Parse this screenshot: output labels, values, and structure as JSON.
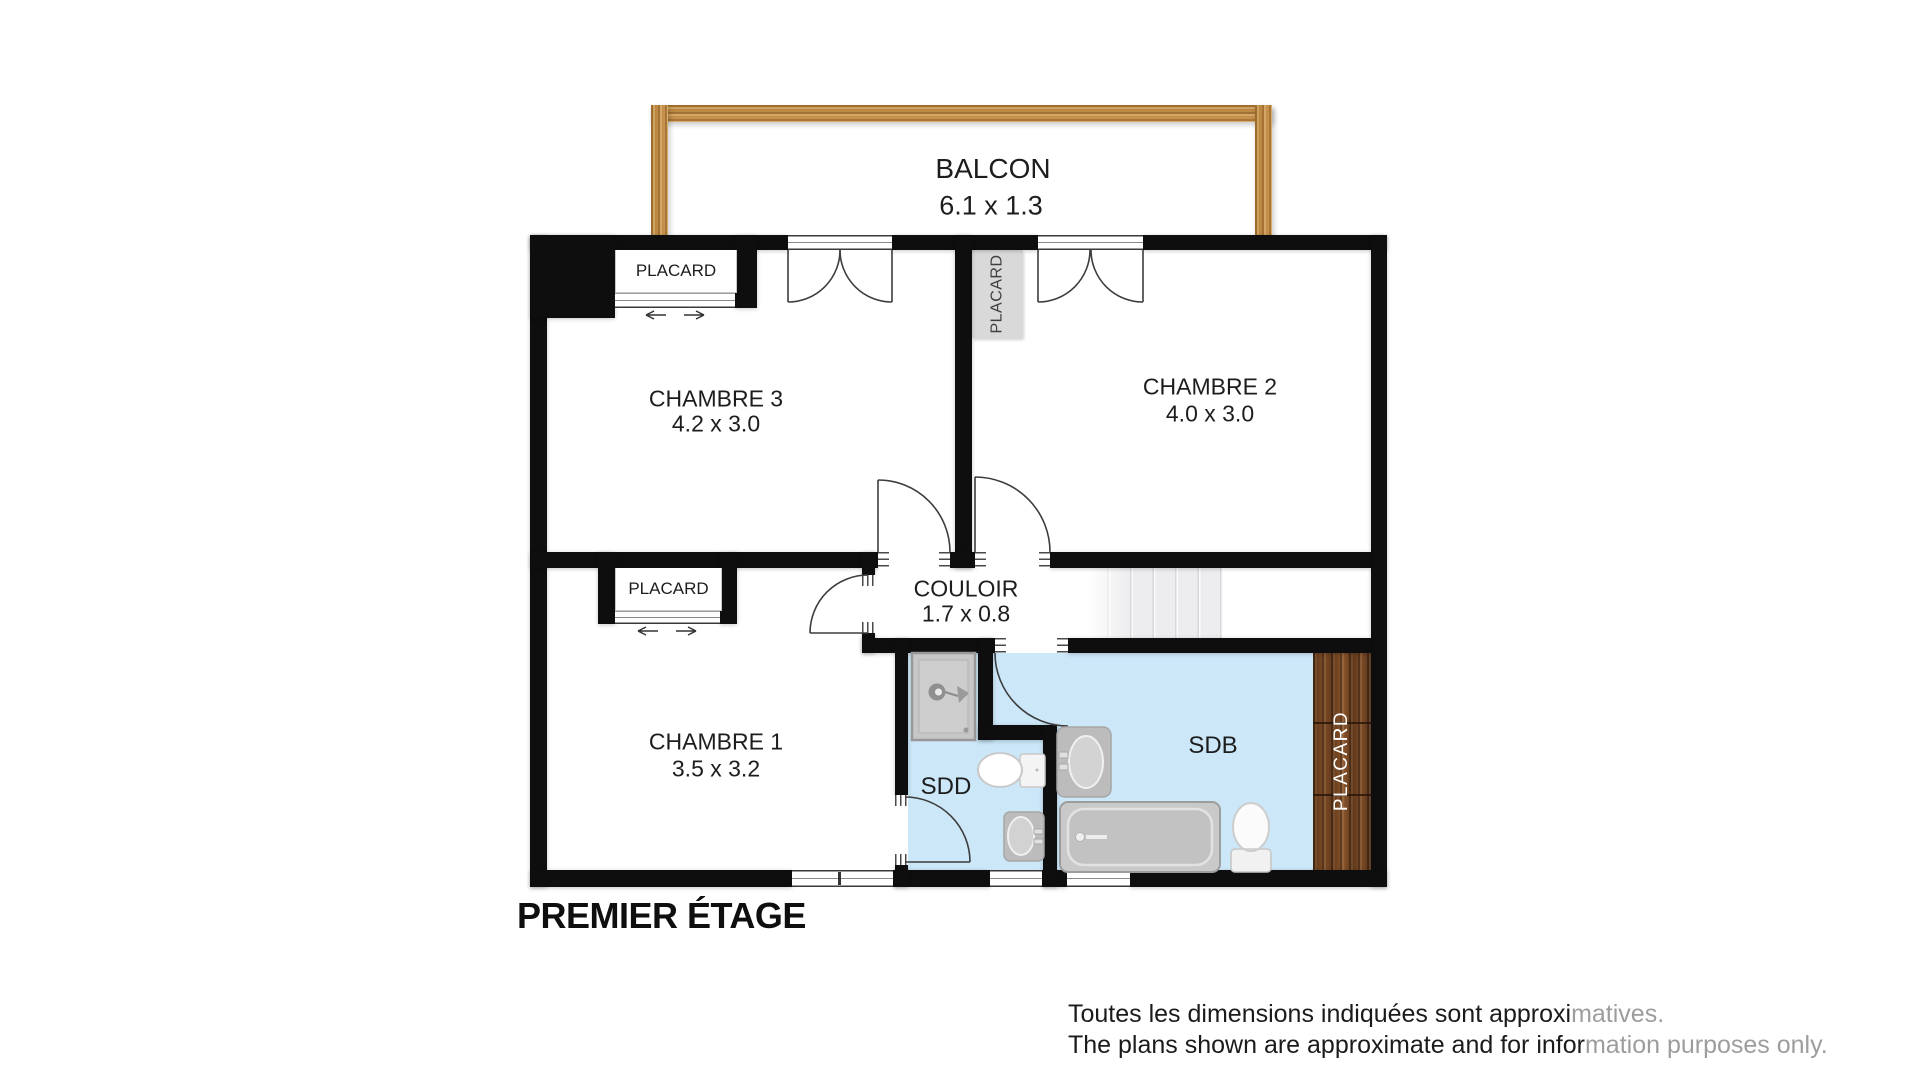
{
  "title": "PREMIER ÉTAGE",
  "balcony": {
    "label": "BALCON",
    "dims": "6.1 x 1.3"
  },
  "rooms": {
    "chambre3": {
      "label": "CHAMBRE 3",
      "dims": "4.2 x 3.0"
    },
    "chambre2": {
      "label": "CHAMBRE 2",
      "dims": "4.0 x 3.0"
    },
    "chambre1": {
      "label": "CHAMBRE 1",
      "dims": "3.5 x 3.2"
    },
    "couloir": {
      "label": "COULOIR",
      "dims": "1.7 x 0.8"
    },
    "sdd": {
      "label": "SDD"
    },
    "sdb": {
      "label": "SDB"
    }
  },
  "closets": {
    "top_left": {
      "label": "PLACARD"
    },
    "mid_left": {
      "label": "PLACARD"
    },
    "center": {
      "label": "PLACARD"
    },
    "wood_right": {
      "label": "PLACARD"
    }
  },
  "disclaimer": {
    "line1_black": "Toutes les dimensions indiquées sont approxi",
    "line1_gray": "matives.",
    "line2_black": "The plans shown are approximate and for infor",
    "line2_gray": "mation purposes only."
  },
  "colors": {
    "wall": "#0e0e0e",
    "bath_blue": "#cbe7f8",
    "balcony_wood": "#bc8a44",
    "closet_wood": "#6b4122",
    "closet_gray": "#d9d9d9",
    "stairs_gray": "#ededef",
    "text": "#1d1d1d",
    "disclaimer_gray": "#9d9d9d"
  }
}
